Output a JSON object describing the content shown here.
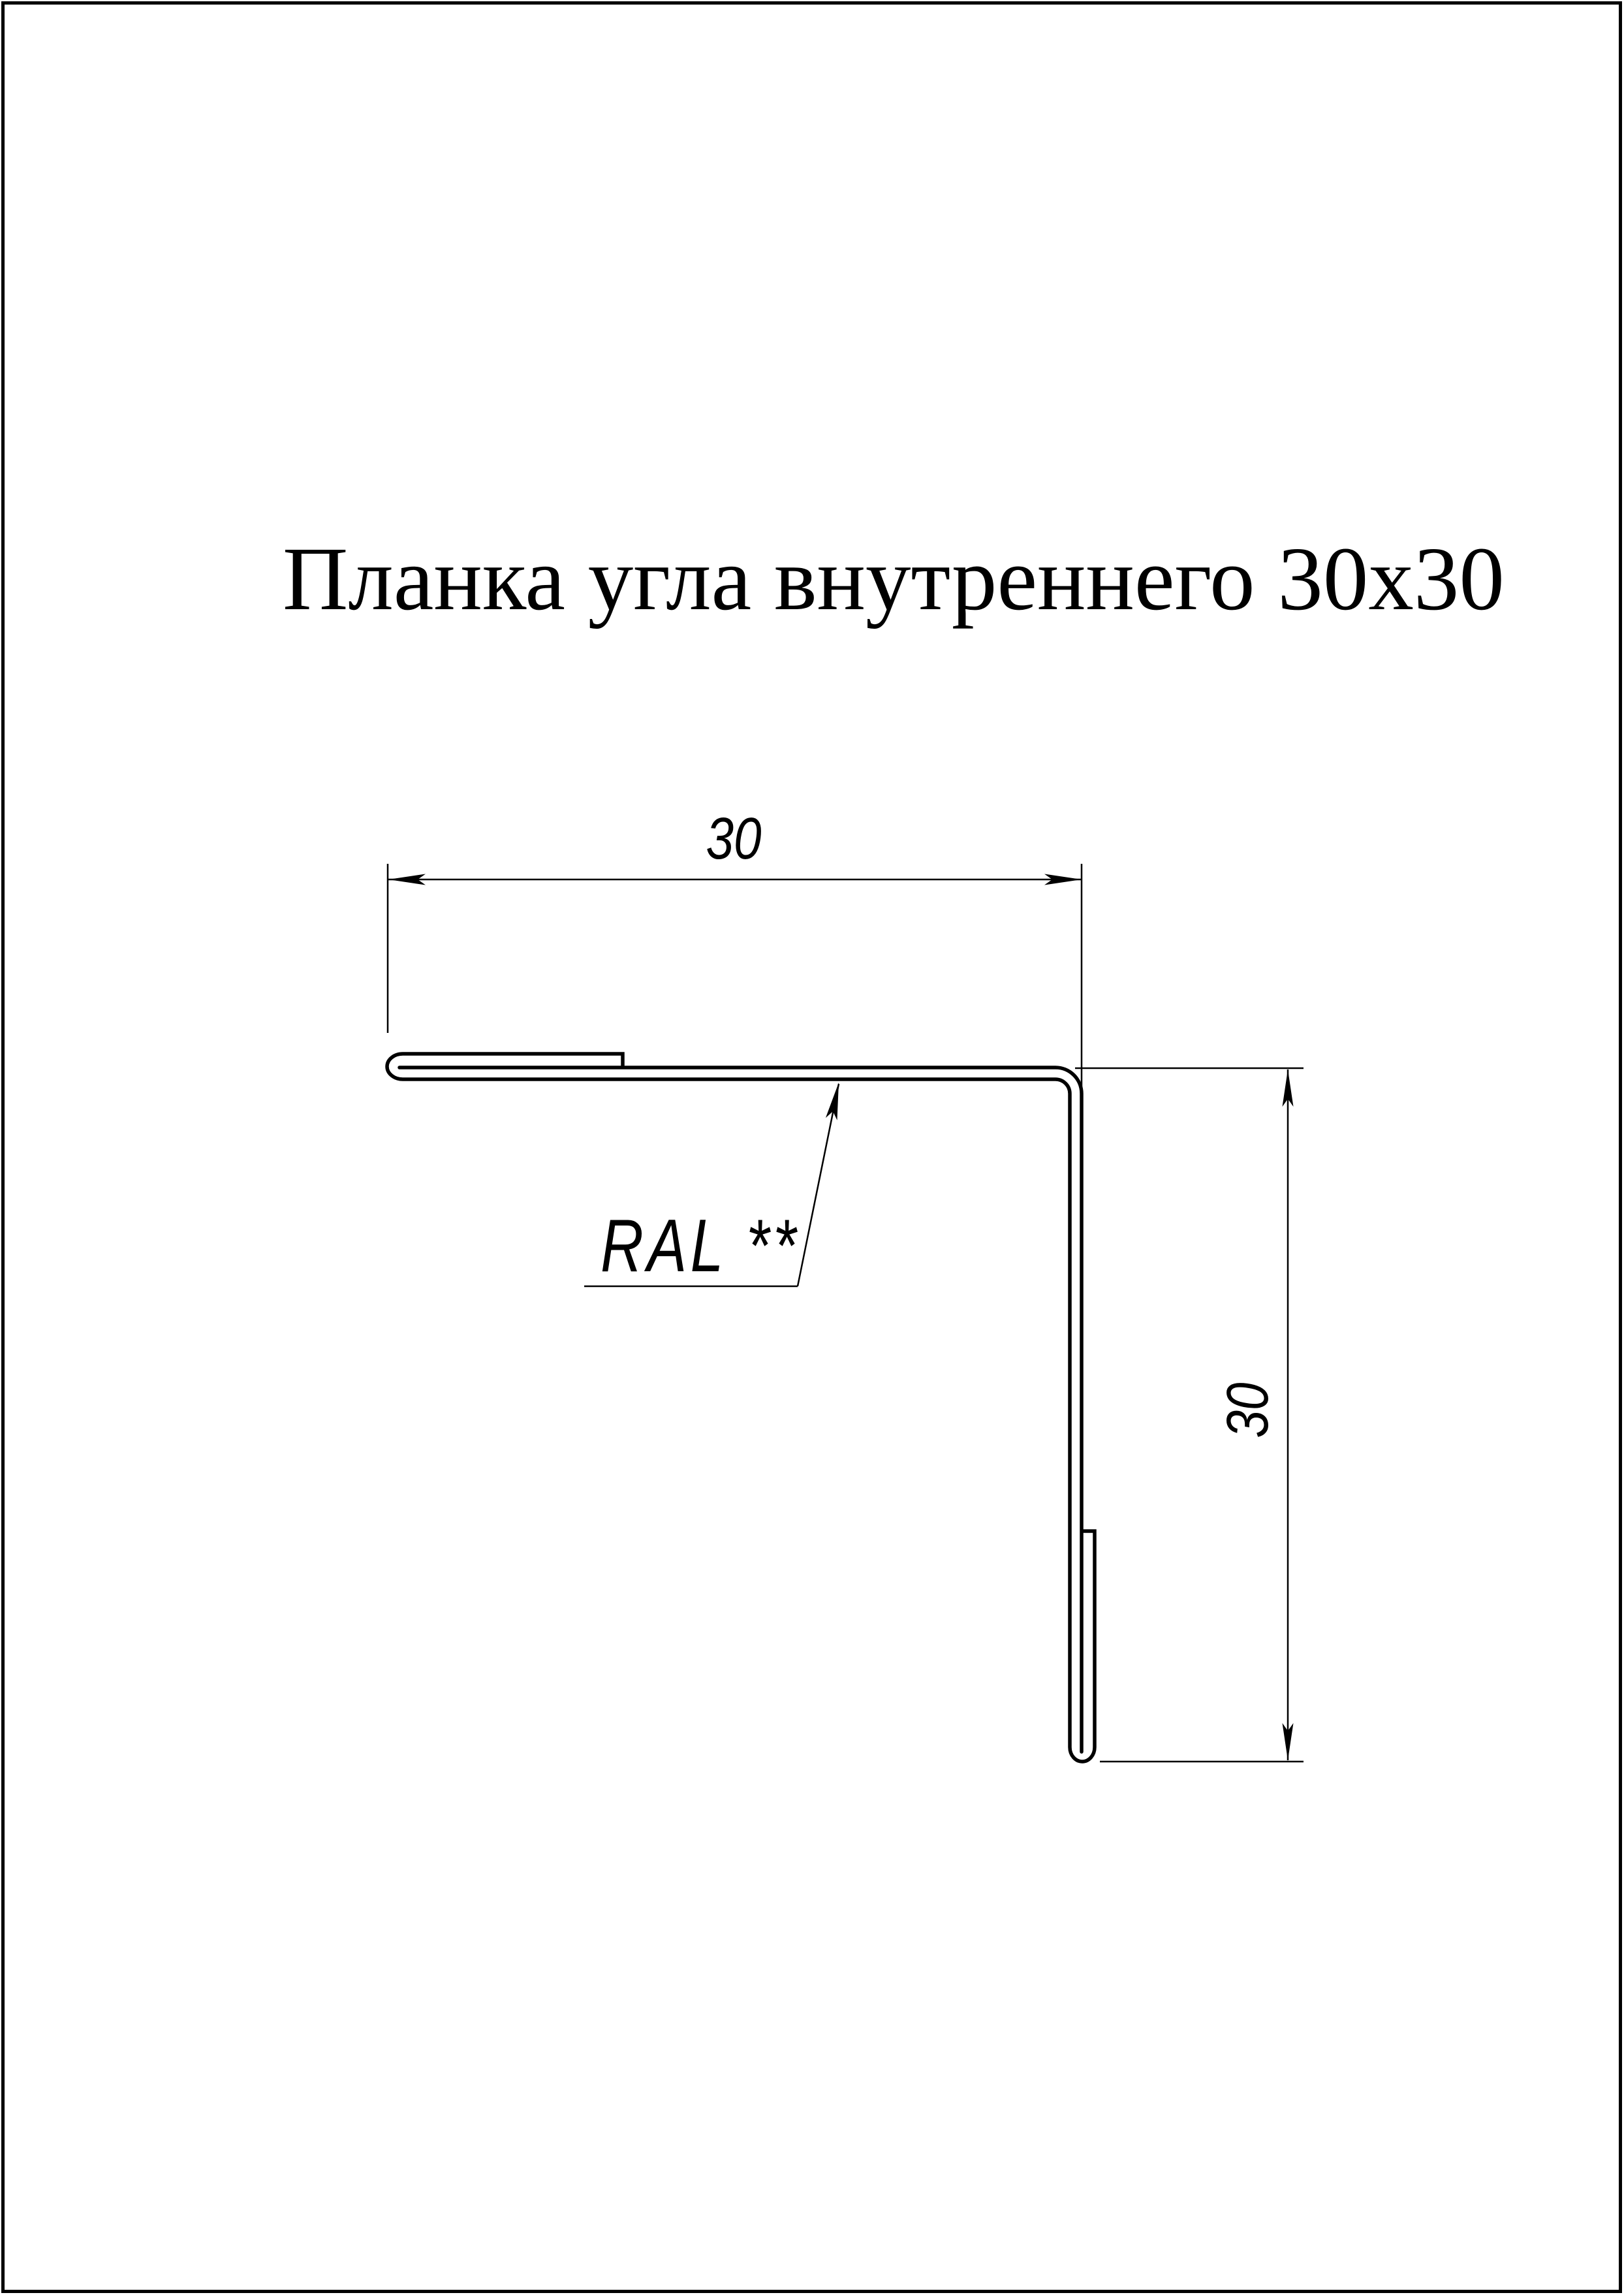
{
  "title": "Планка угла внутреннего 30x30",
  "dimensions": {
    "top": "30",
    "right": "30"
  },
  "labels": {
    "ral": "RAL **"
  },
  "colors": {
    "line": "#000000",
    "background": "#ffffff"
  }
}
